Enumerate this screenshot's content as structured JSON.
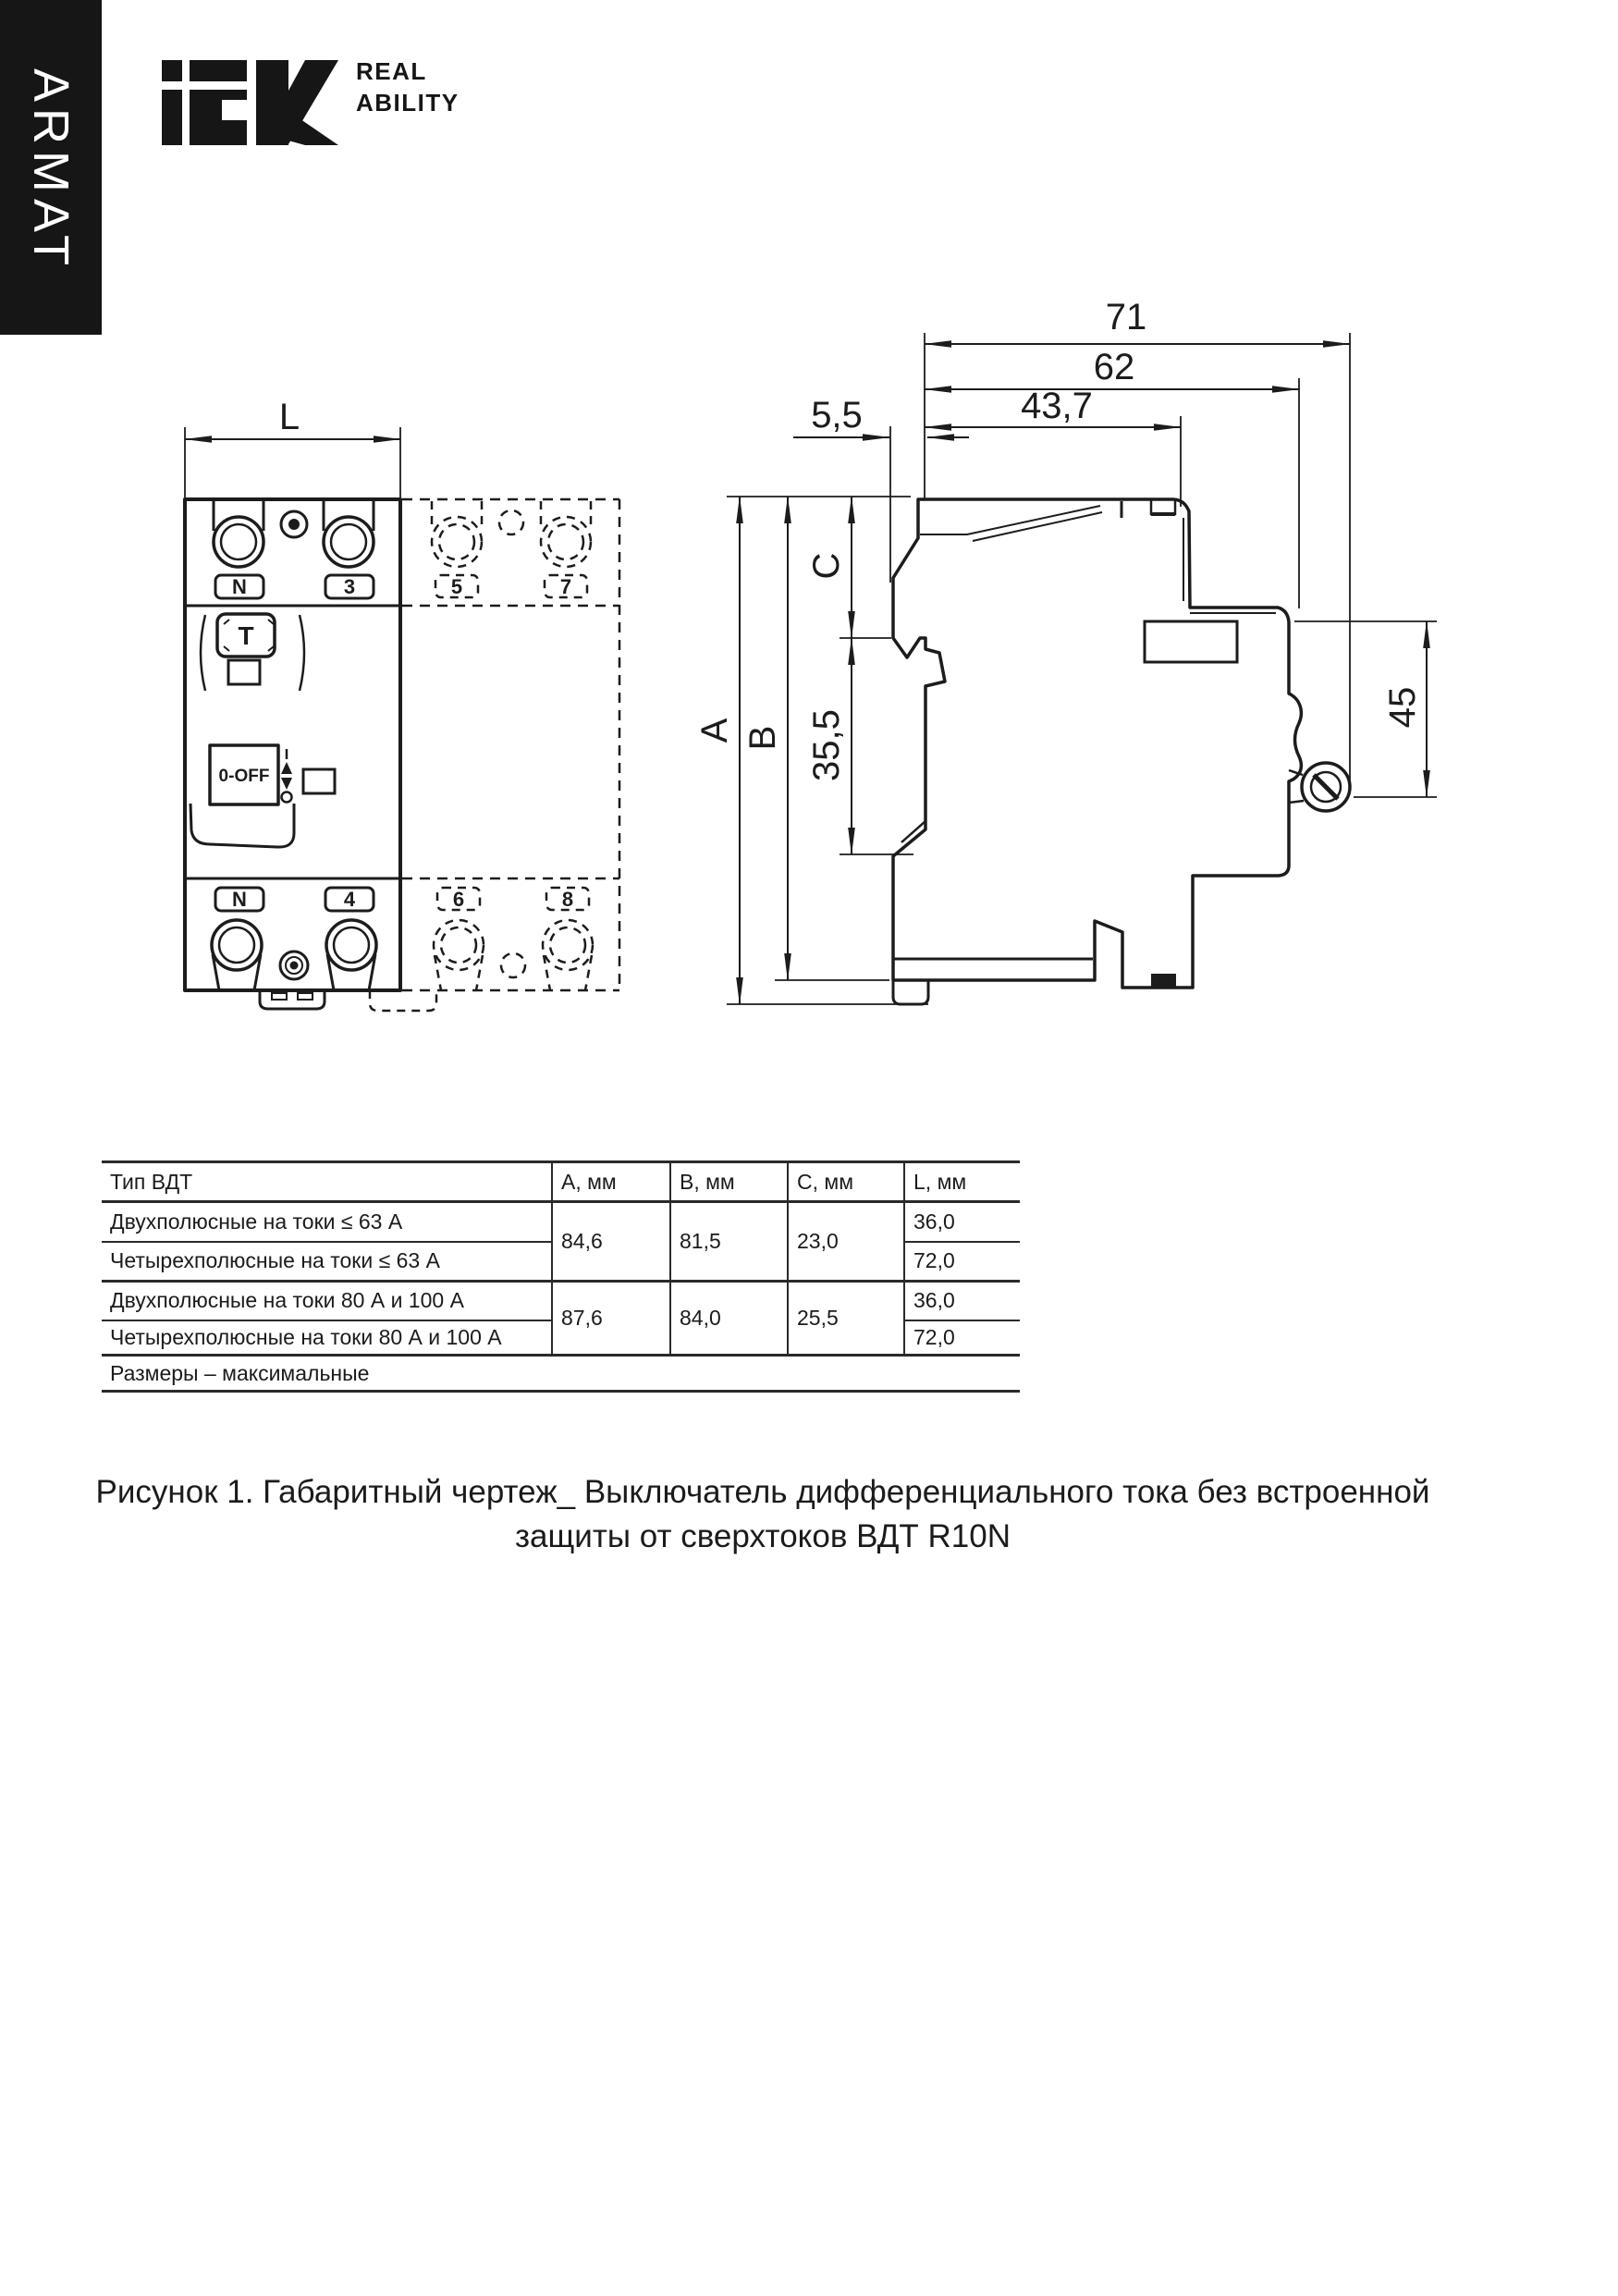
{
  "brand": {
    "vertical_label": "ARMAT",
    "logo_text": "iek",
    "tagline_line1": "REAL",
    "tagline_line2": "ABILITY"
  },
  "front_view": {
    "width_dim": "L",
    "terminal_top_left": "N",
    "terminal_top_right": "3",
    "terminal_bottom_left": "N",
    "terminal_bottom_right": "4",
    "phantom_top_left": "5",
    "phantom_top_right": "7",
    "phantom_bottom_left": "6",
    "phantom_bottom_right": "8",
    "test_button": "T",
    "switch_label": "0-OFF"
  },
  "side_view": {
    "depth_overall": "71",
    "depth_body": "62",
    "din_offset": "5,5",
    "depth_front": "43,7",
    "height_overall": "A",
    "height_body": "B",
    "top_to_rail": "C",
    "rail_opening": "35,5",
    "front_height": "45"
  },
  "table": {
    "headers": [
      "Тип ВДТ",
      "A, мм",
      "B, мм",
      "C, мм",
      "L, мм"
    ],
    "rows": [
      {
        "type": "Двухполюсные на токи ≤ 63 А",
        "a": "84,6",
        "b": "81,5",
        "c": "23,0",
        "l": "36,0"
      },
      {
        "type": "Четырехполюсные на токи ≤ 63 А",
        "l": "72,0"
      },
      {
        "type": "Двухполюсные на токи 80 А и 100 А",
        "a": "87,6",
        "b": "84,0",
        "c": "25,5",
        "l": "36,0"
      },
      {
        "type": "Четырехполюсные на токи 80 А и 100 А",
        "l": "72,0"
      }
    ],
    "footnote": "Размеры – максимальные"
  },
  "caption": {
    "line1": "Рисунок 1. Габаритный чертеж_ Выключатель дифференциального тока без встроенной",
    "line2": "защиты от сверхтоков ВДТ R10N"
  }
}
